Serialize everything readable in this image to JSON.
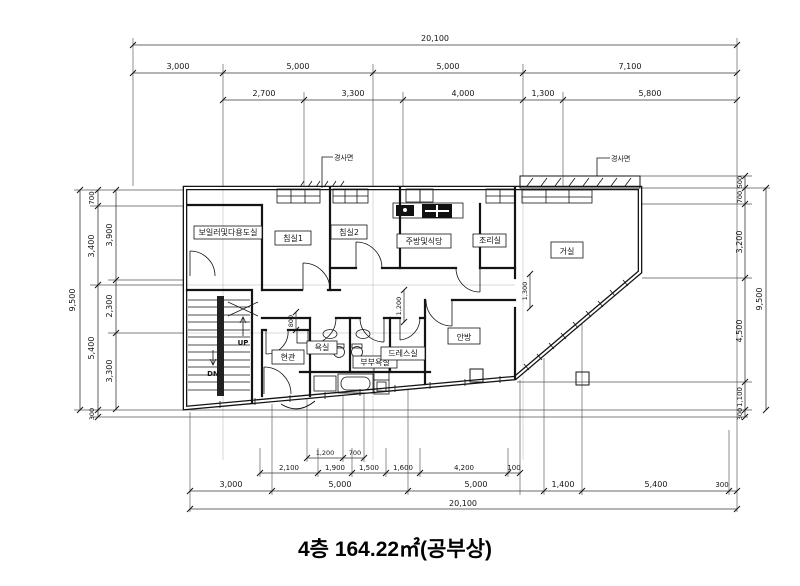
{
  "title": "4층 164.22㎡(공부상)",
  "rooms": {
    "boiler": "보일러및다용도실",
    "bed1": "침실1",
    "bed2": "침실2",
    "kitchen": "주방및식당",
    "pantry": "조리실",
    "living": "거실",
    "master": "안방",
    "entrance": "현관",
    "bath": "욕실",
    "master_bath": "부부욕실",
    "dress": "드레스실"
  },
  "stairs": {
    "up": "UP",
    "down": "DN"
  },
  "notes": {
    "slope_left": "경사면",
    "slope_right": "경사면"
  },
  "dims": {
    "top": {
      "overall": "20,100",
      "row2": [
        "3,000",
        "5,000",
        "5,000",
        "7,100"
      ],
      "row3": [
        "2,700",
        "3,300",
        "4,000",
        "1,300",
        "5,800"
      ]
    },
    "bottom": {
      "overall": "20,100",
      "main": [
        "3,000",
        "5,000",
        "5,000",
        "1,400",
        "5,400",
        "300"
      ],
      "detail": [
        "2,100",
        "1,900",
        "1,500",
        "1,600",
        "4,200",
        "100"
      ],
      "fine": [
        "1,200",
        "700"
      ]
    },
    "left": {
      "overall": "9,500",
      "outer": [
        "700",
        "3,400",
        "5,400",
        "300"
      ],
      "inner": [
        "3,900",
        "2,300",
        "3,300"
      ]
    },
    "right": {
      "overall": "9,500",
      "segments": [
        "500",
        "700",
        "3,200",
        "4,500",
        "1,100",
        "300"
      ]
    },
    "interior": [
      "1,300",
      "1,200",
      "800"
    ]
  }
}
